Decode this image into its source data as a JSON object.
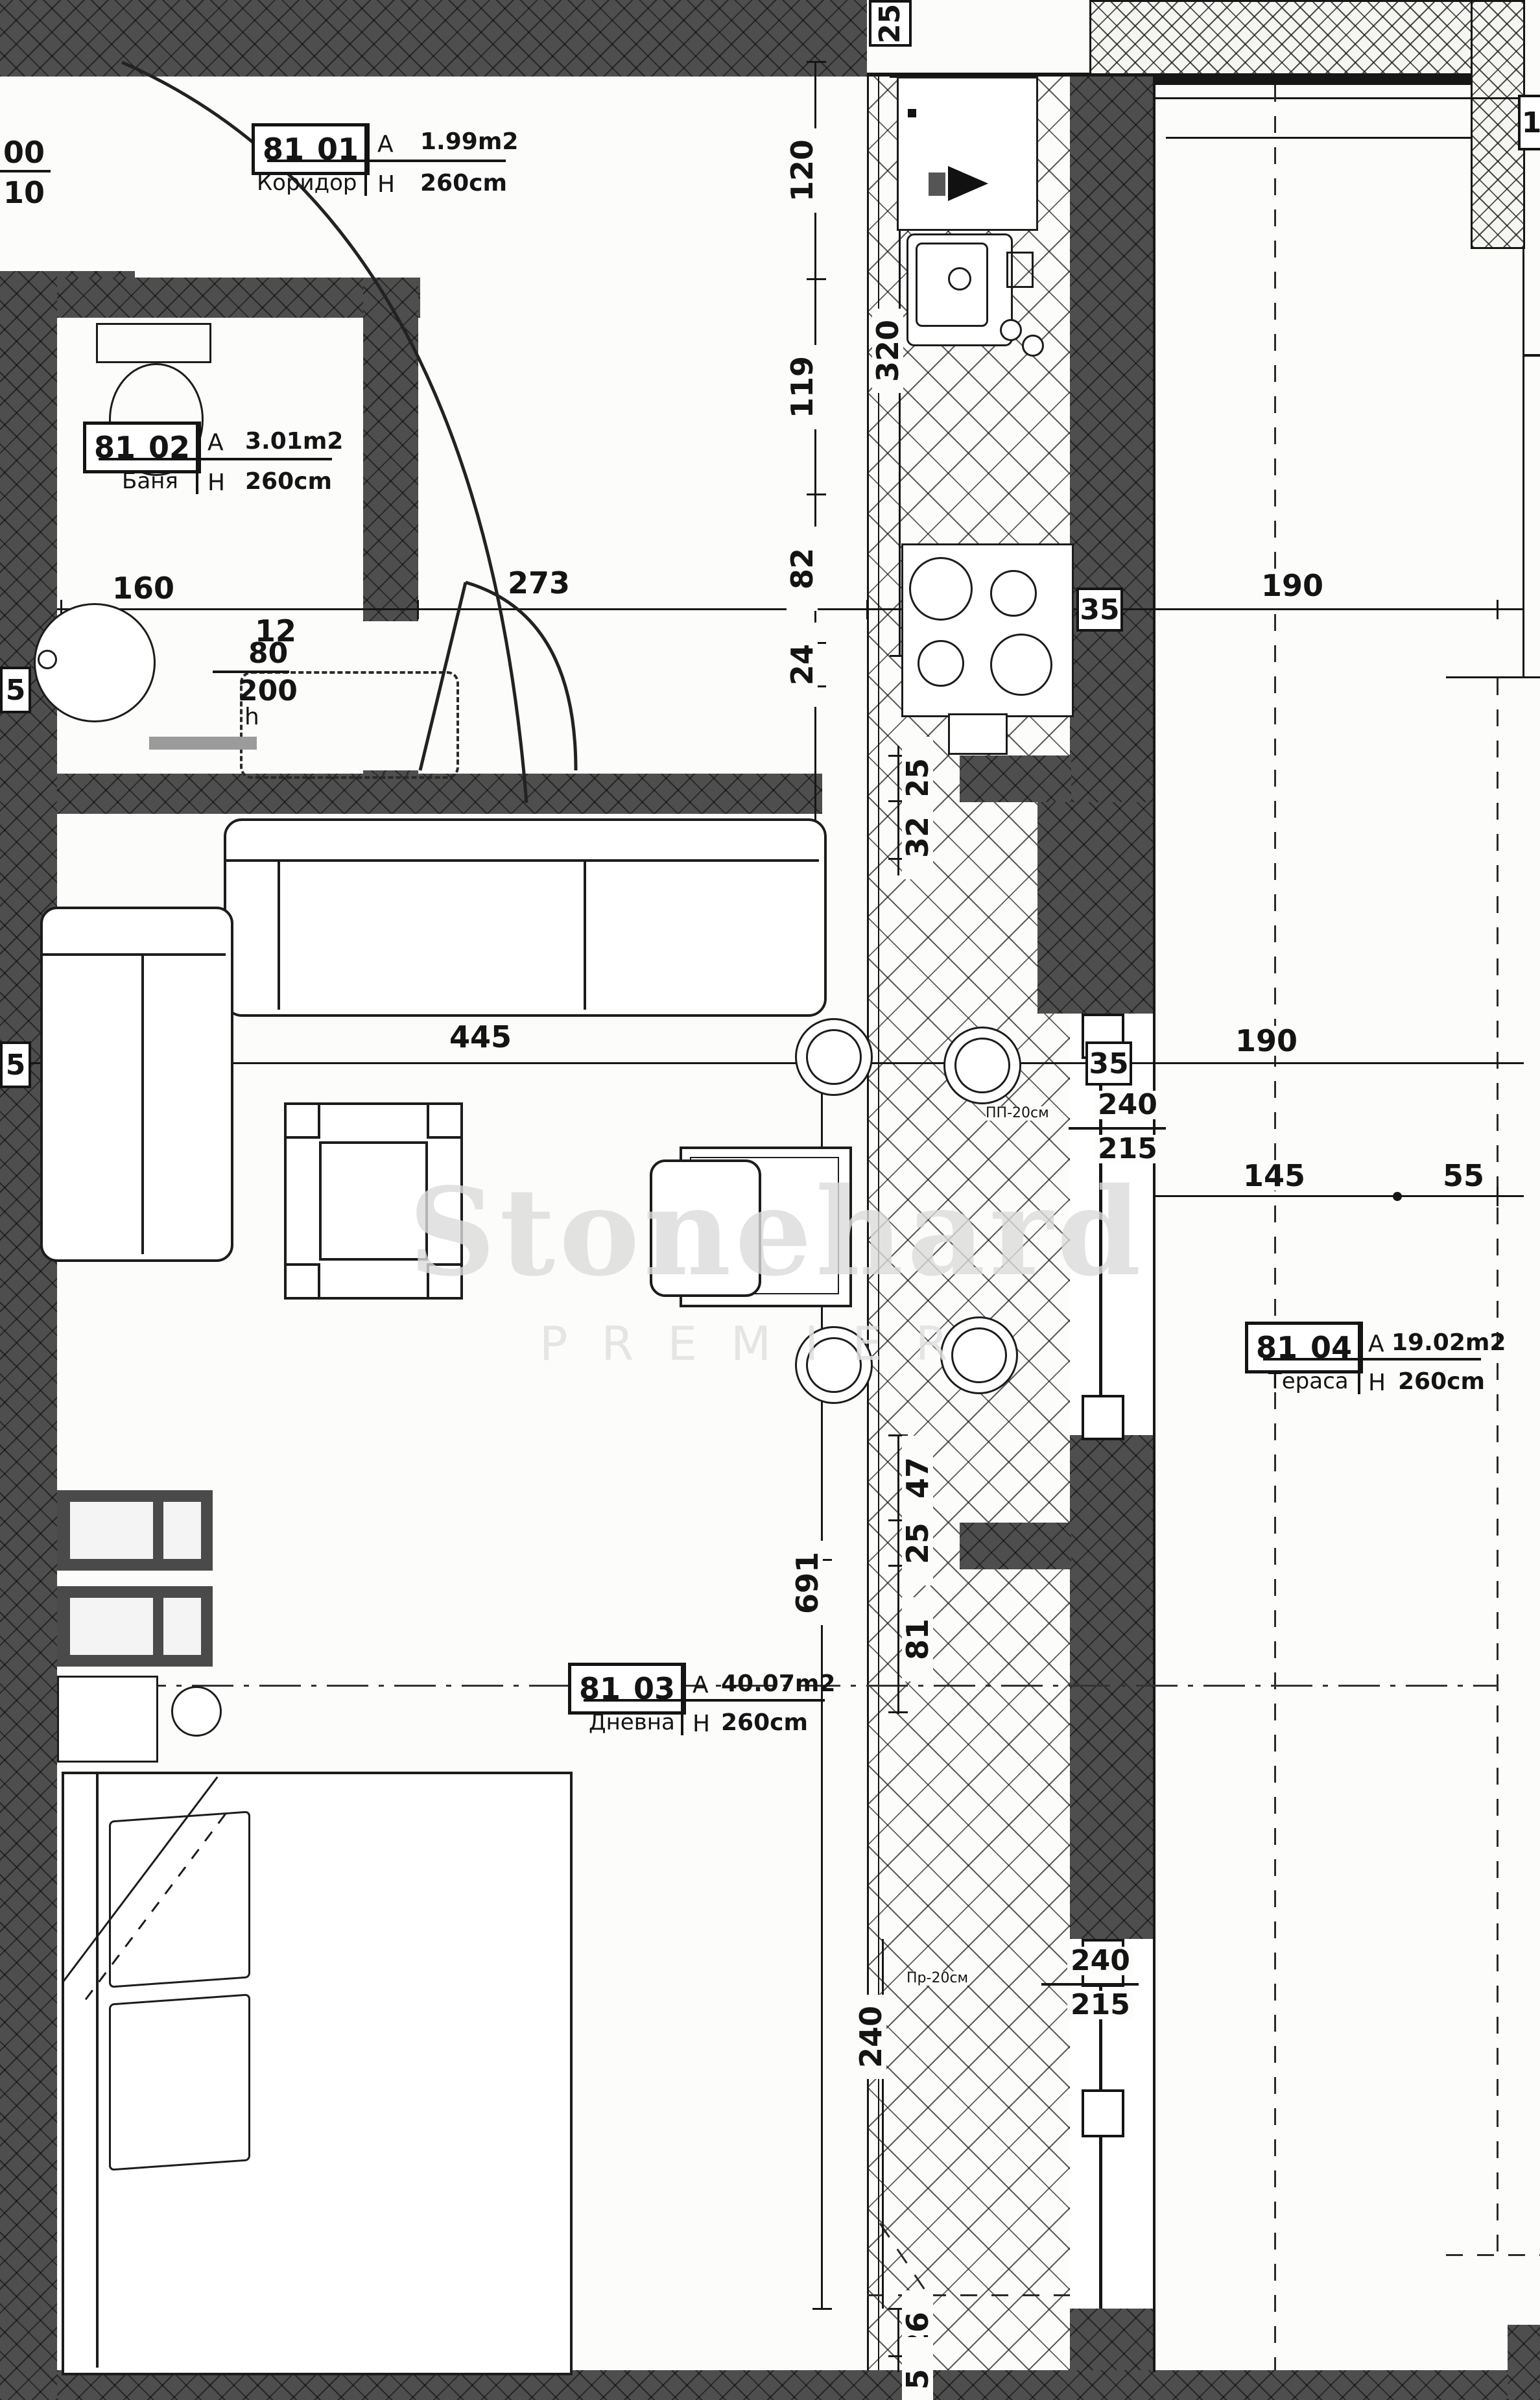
{
  "watermark": {
    "line1": "Stonehard",
    "line2": "PREMIER"
  },
  "labels": {
    "area": "A",
    "height": "H"
  },
  "rooms": [
    {
      "code": "81",
      "unit": "01",
      "name": "Коридор",
      "area": "1.99m2",
      "height": "260cm"
    },
    {
      "code": "81",
      "unit": "02",
      "name": "Баня",
      "area": "3.01m2",
      "height": "260cm"
    },
    {
      "code": "81",
      "unit": "03",
      "name": "Дневна",
      "area": "40.07m2",
      "height": "260cm"
    },
    {
      "code": "81",
      "unit": "04",
      "name": "Тераса",
      "area": "19.02m2",
      "height": "260cm"
    }
  ],
  "dims": {
    "h_top": [
      "160",
      "12",
      "273",
      "35",
      "190"
    ],
    "h_mid": [
      "5",
      "445",
      "35",
      "190"
    ],
    "h_terrace": [
      "145",
      "55"
    ],
    "v_outer": [
      "120",
      "119",
      "82",
      "24"
    ],
    "v_kitchen": "320",
    "v_col_upper": [
      "25",
      "32"
    ],
    "v_col_lower": [
      "47",
      "25",
      "81"
    ],
    "v_living": "691",
    "v_window": "240",
    "v_bottom": [
      "26",
      "5"
    ],
    "top_wall": "25",
    "right_partial": "1"
  },
  "annotations": {
    "door_entry": {
      "top": "00",
      "bottom": "10"
    },
    "door_bath": {
      "top": "80",
      "bottom": "200",
      "handle": "h"
    },
    "window_side": {
      "note": "ПП-20см",
      "top": "240",
      "bottom": "215"
    },
    "window_bottom": {
      "note": "Пр-20см",
      "top": "240",
      "bottom": "215"
    }
  }
}
